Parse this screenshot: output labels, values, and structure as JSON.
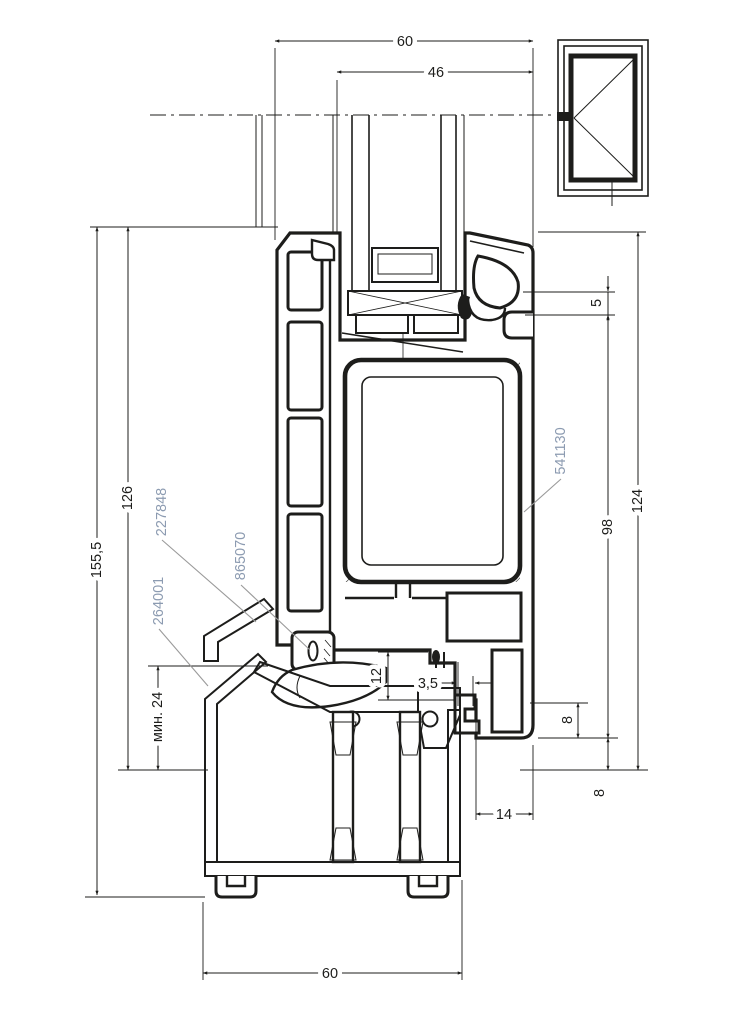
{
  "drawing": {
    "type": "window-profile-cross-section",
    "colors": {
      "line": "#1d1d1b",
      "part_label": "#8c9bb1",
      "leader": "#9a9a9a",
      "background": "#ffffff"
    },
    "dimensions": {
      "top_outer_width": "60",
      "top_glazing_width": "46",
      "overall_height": "155,5",
      "sash_height": "126",
      "min_glazing_depth": "мин. 24",
      "bead_step": "5",
      "right_height_98": "98",
      "right_height_124": "124",
      "rebate_gap_upper": "8",
      "rebate_gap_lower": "8",
      "sash_clearance": "12",
      "drainage_gap": "3,5",
      "overhang_width": "14",
      "bottom_outer_width": "60"
    },
    "part_numbers": {
      "drip_cap": "227848",
      "frame_profile": "264001",
      "gasket": "865070",
      "steel_reinforcement": "541130"
    },
    "symbol": "window-elevation-opening-left"
  }
}
